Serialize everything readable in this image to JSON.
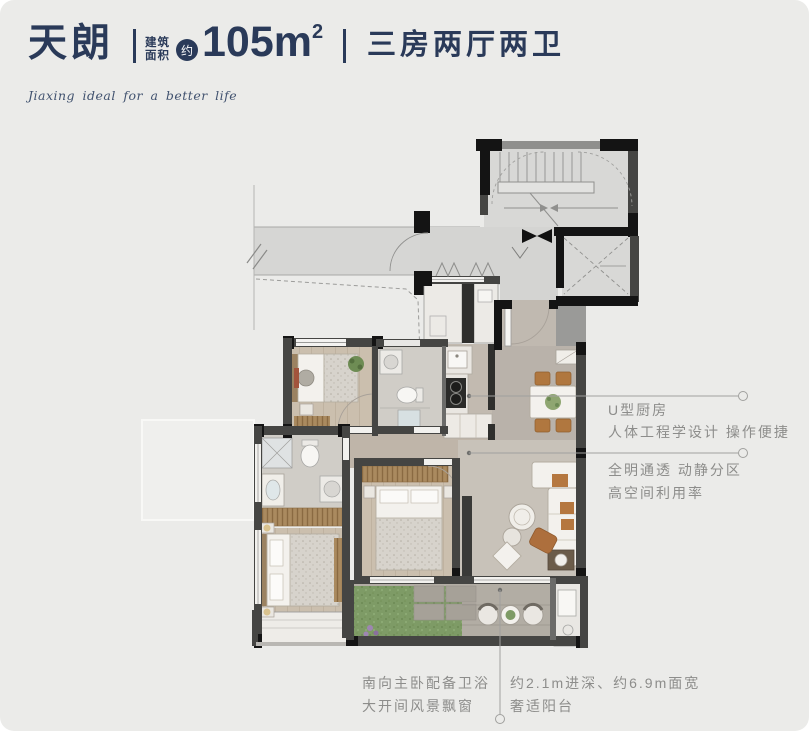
{
  "colors": {
    "navy": "#2a3a59",
    "ann": "#8d8d8b",
    "bg": "#ebebe9",
    "wall_dark": "#454543",
    "wall_black": "#141414",
    "common_floor": "#d6d6d4",
    "wood_floor": "#cbbfae",
    "tile_floor": "#d0cdc7",
    "grass": "#7e9b66",
    "furniture_wood": "#aa8a5f",
    "accent_orange": "#b5773f"
  },
  "header": {
    "name": "天朗",
    "area_label_line1": "建筑",
    "area_label_line2": "面积",
    "approx_badge": "约",
    "area_value": "105m",
    "area_sup": "2",
    "layout": "三房两厅两卫",
    "tagline": "Jiaxing ideal for a better life"
  },
  "annotations": {
    "right": [
      {
        "lines": [
          "U型厨房",
          "人体工程学设计 操作便捷"
        ]
      },
      {
        "lines": [
          "全明通透 动静分区",
          "高空间利用率"
        ]
      }
    ],
    "bottom_left": [
      "南向主卧配备卫浴",
      "大开间风景飘窗"
    ],
    "bottom_right": [
      "约2.1m进深、约6.9m面宽",
      "奢适阳台"
    ]
  }
}
